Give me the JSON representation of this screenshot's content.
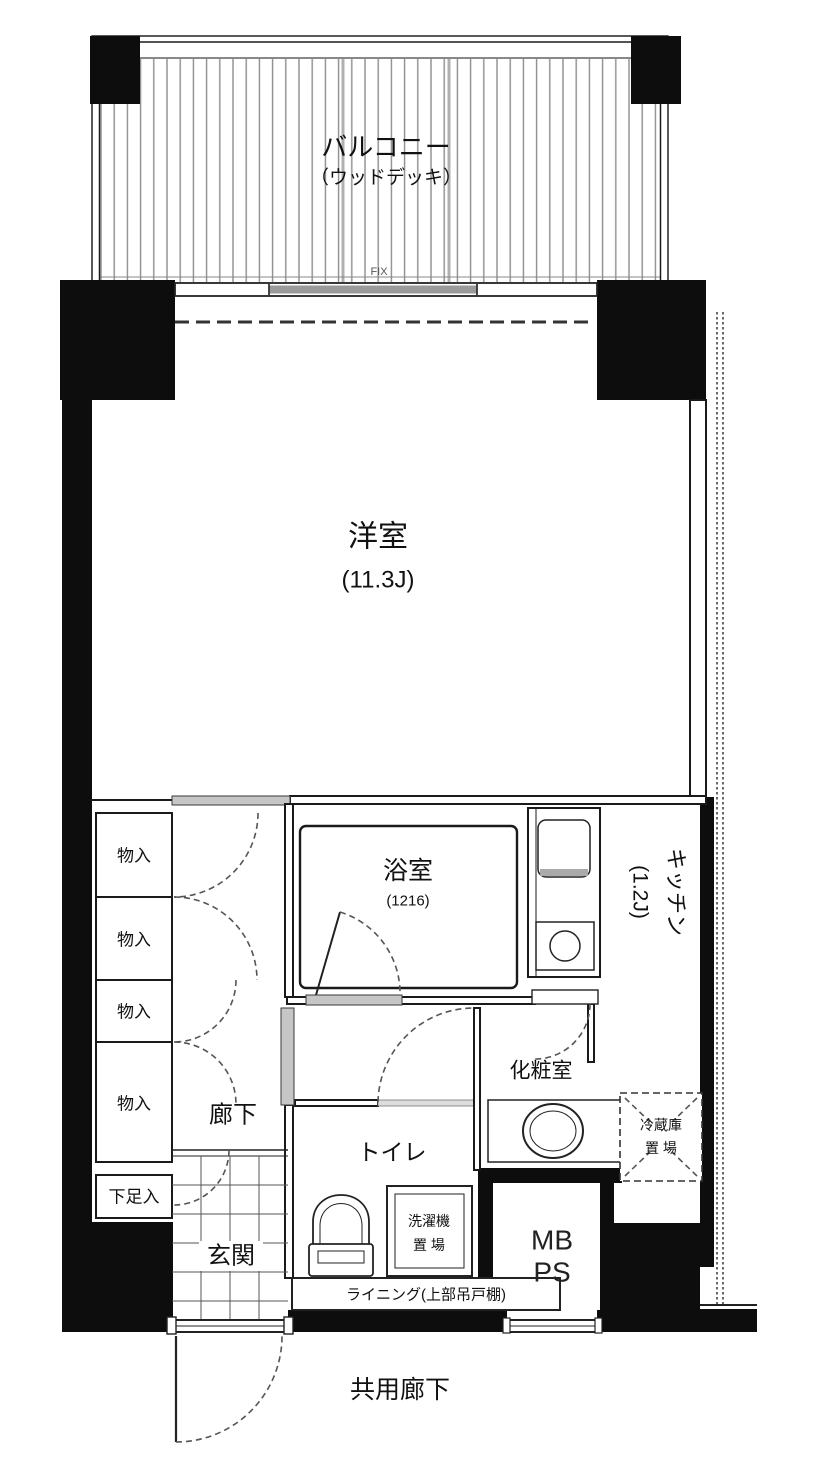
{
  "balcony": {
    "label": "バルコニー",
    "sublabel": "（ウッドデッキ）",
    "window_label": "FIX"
  },
  "living_room": {
    "label": "洋室",
    "size": "(11.3J)"
  },
  "kitchen": {
    "label": "キッチン",
    "size": "(1.2J)"
  },
  "bathroom": {
    "label": "浴室",
    "size": "(1216)"
  },
  "closets": {
    "items": [
      "物入",
      "物入",
      "物入",
      "物入"
    ],
    "shoe": "下足入"
  },
  "hallway": {
    "label": "廊下"
  },
  "entrance": {
    "label": "玄関"
  },
  "toilet": {
    "label": "トイレ"
  },
  "washer": {
    "line1": "洗濯機",
    "line2": "置 場"
  },
  "powder_room": {
    "label": "化粧室"
  },
  "fridge": {
    "line1": "冷蔵庫",
    "line2": "置 場"
  },
  "meter_box": {
    "line1": "MB",
    "line2": "PS"
  },
  "lining": {
    "label": "ライニング(上部吊戸棚)"
  },
  "common_corridor": {
    "label": "共用廊下"
  },
  "colors": {
    "wall": "#0d0d0d",
    "line": "#1a1a1a",
    "sill": "#c6c6c6"
  }
}
